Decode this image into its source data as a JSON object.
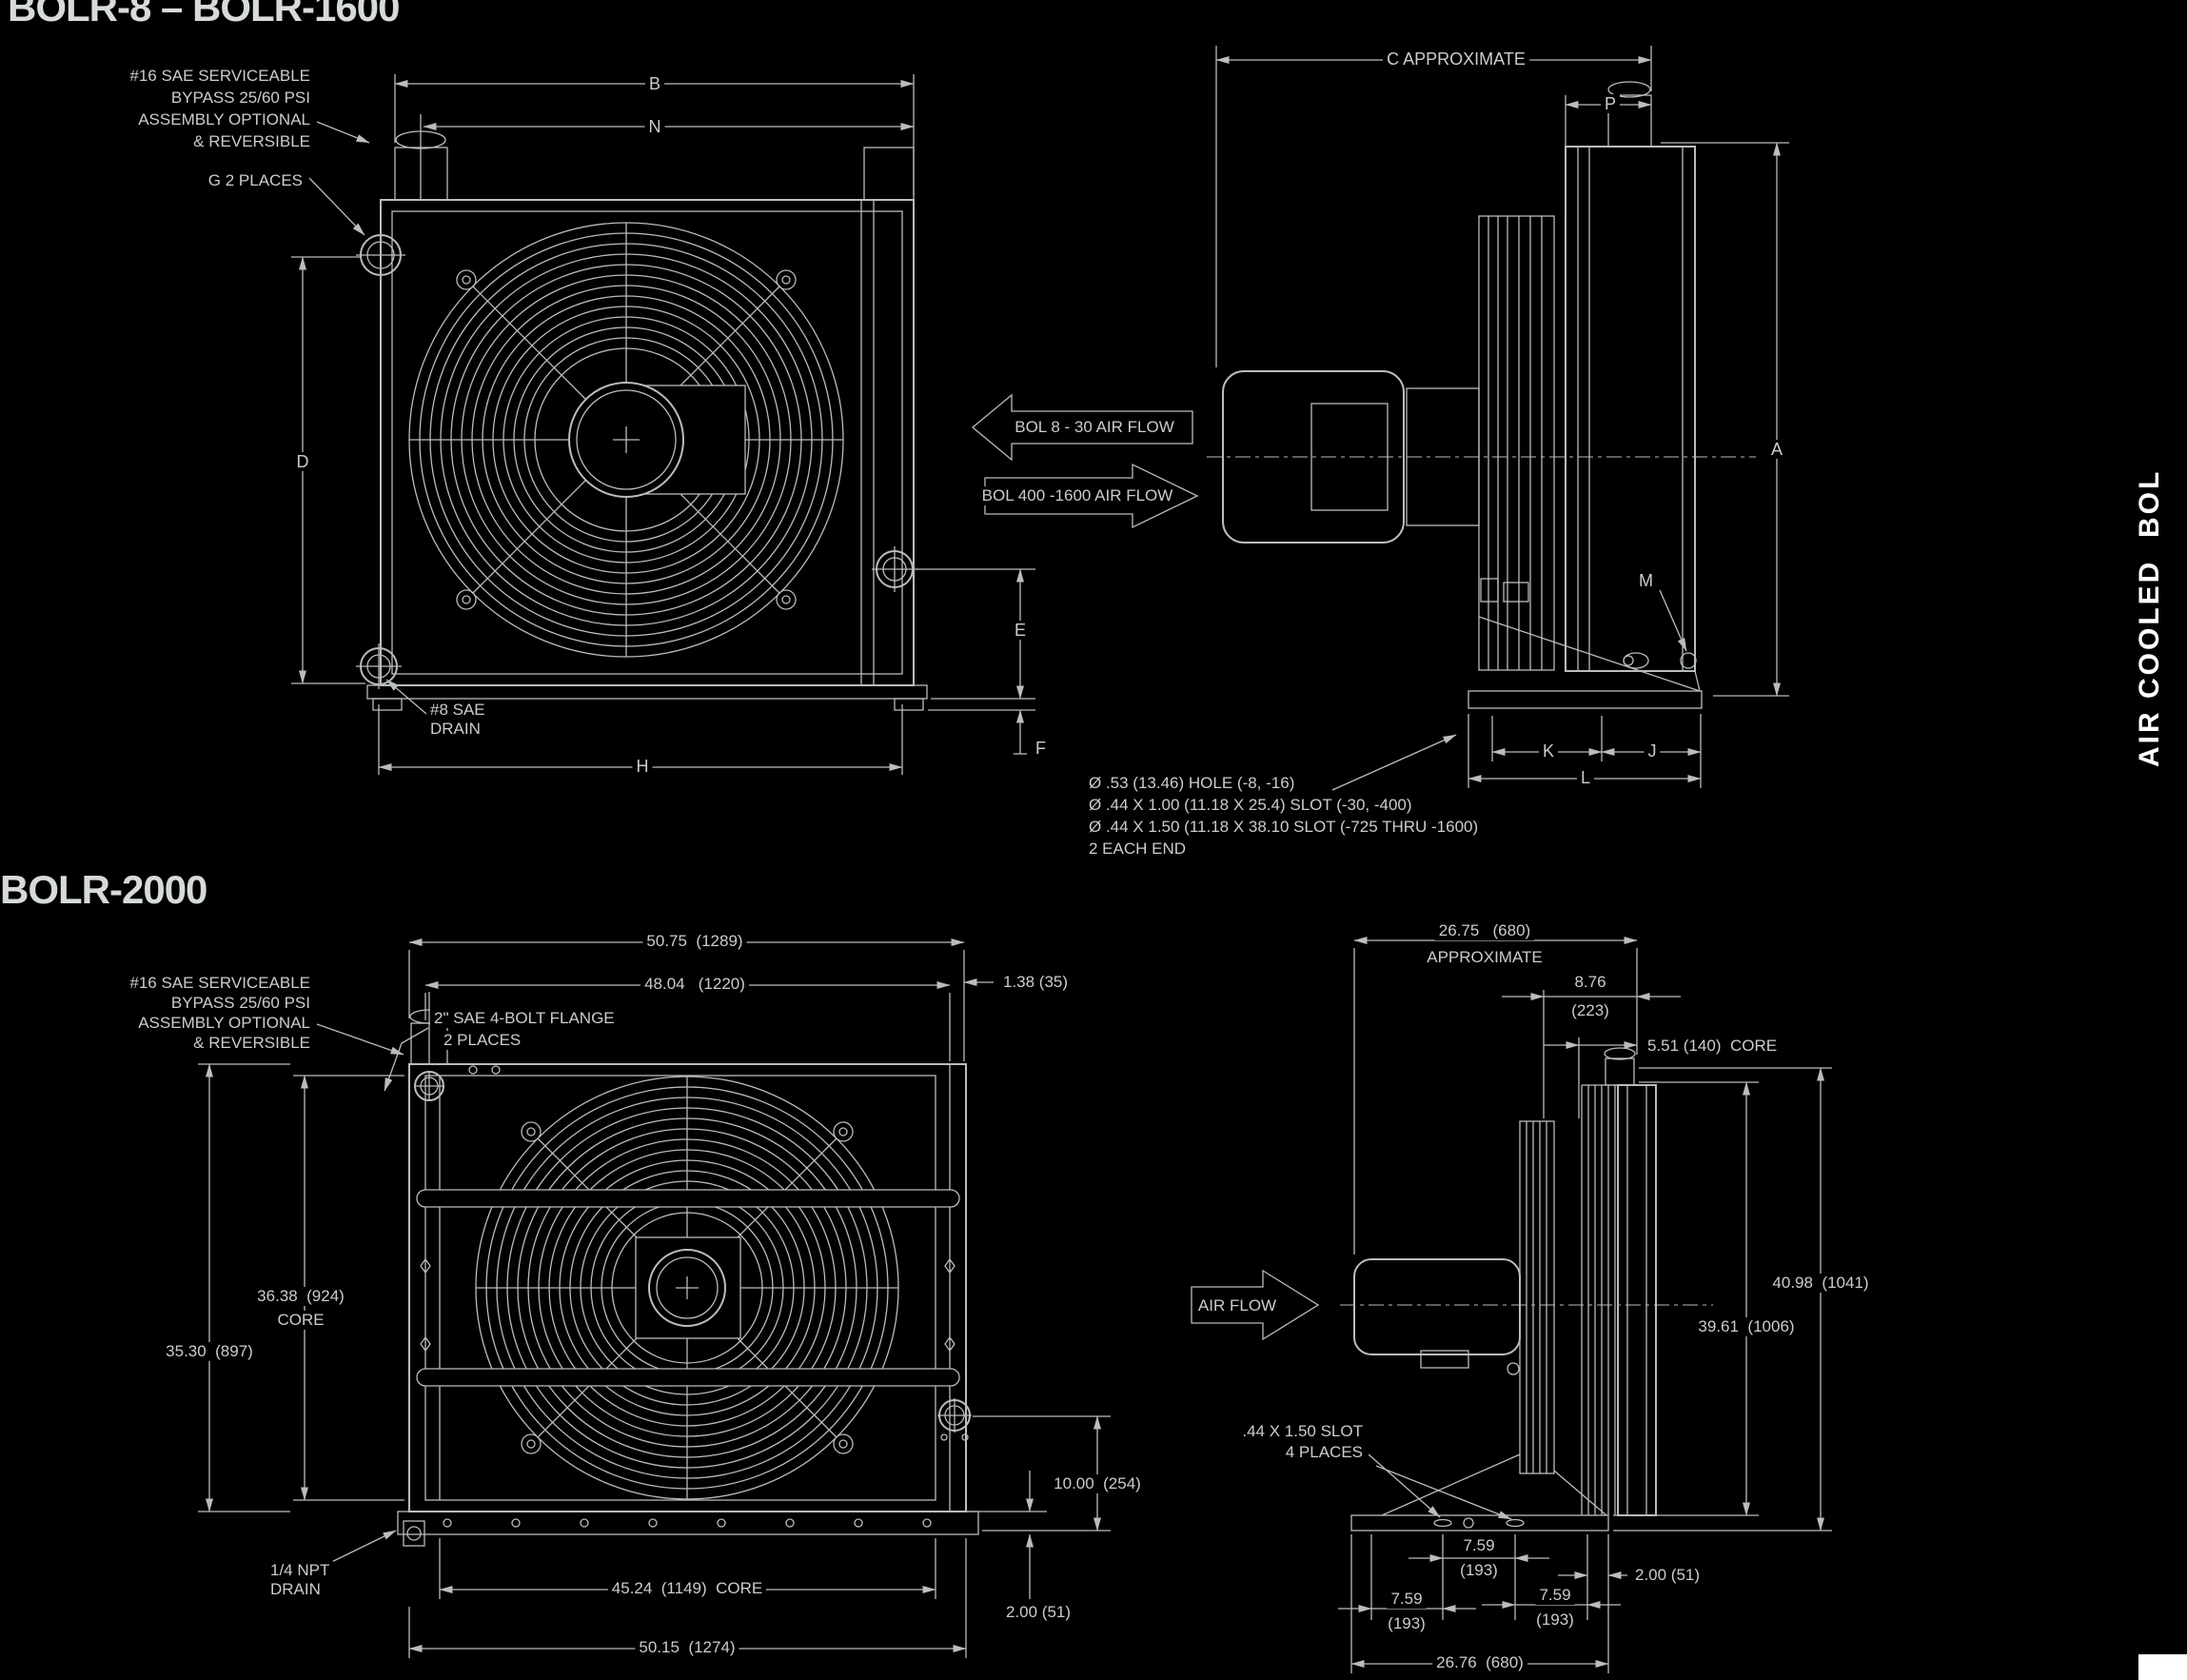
{
  "theme": {
    "background": "#000000",
    "line_color": "#b9bdbd",
    "text_color": "#c9cdcd",
    "title_color": "#d6dada",
    "brand_color": "#ffffff",
    "corner_color": "#ffffff"
  },
  "s1": {
    "title": "BOLR-8 – BOLR-1600",
    "bypass": [
      "#16 SAE SERVICEABLE",
      "BYPASS 25/60 PSI",
      "ASSEMBLY OPTIONAL",
      "& REVERSIBLE"
    ],
    "g_note": "G 2 PLACES",
    "drain": [
      "#8 SAE",
      "DRAIN"
    ],
    "dims": {
      "b": "B",
      "n": "N",
      "d": "D",
      "h": "H",
      "e": "E",
      "f": "F",
      "c": "C APPROXIMATE",
      "p": "P",
      "a": "A",
      "m": "M",
      "k": "K",
      "j": "J",
      "l": "L"
    },
    "airflow_left": "BOL 8 - 30 AIR FLOW",
    "airflow_right": "BOL 400 -1600 AIR FLOW",
    "hole_notes": [
      "Ø .53 (13.46) HOLE (-8, -16)",
      "Ø .44 X 1.00 (11.18 X 25.4) SLOT (-30, -400)",
      "Ø .44 X 1.50 (11.18 X 38.10 SLOT (-725 THRU -1600)",
      "2 EACH END"
    ]
  },
  "s2": {
    "title": "BOLR-2000",
    "bypass": [
      "#16 SAE SERVICEABLE",
      "BYPASS 25/60 PSI",
      "ASSEMBLY OPTIONAL",
      "& REVERSIBLE"
    ],
    "flange": [
      "2\" SAE 4-BOLT FLANGE",
      "2 PLACES"
    ],
    "drain": [
      "1/4 NPT",
      "DRAIN"
    ],
    "front_dims": {
      "w_overall": "50.75  (1289)",
      "w_inner": "48.04   (1220)",
      "offset": "1.38 (35)",
      "core_h": "36.38  (924)",
      "core_h2": "CORE",
      "h": "35.30  (897)",
      "leg": "10.00  (254)",
      "base": "2.00 (51)",
      "core_w": "45.24  (1149)  CORE",
      "w_bottom": "50.15  (1274)"
    },
    "airflow": "AIR FLOW",
    "slot_note": [
      ".44 X 1.50 SLOT",
      "4 PLACES"
    ],
    "side_dims": {
      "depth": "26.75   (680)",
      "depth2": "APPROXIMATE",
      "motor": "8.76",
      "motor2": "(223)",
      "core": "5.51 (140)  CORE",
      "h_overall": "40.98  (1041)",
      "h_core": "39.61  (1006)",
      "f1": "7.59",
      "f1b": "(193)",
      "f2": "7.59",
      "f2b": "(193)",
      "f3": "7.59",
      "f3b": "(193)",
      "edge": "2.00 (51)",
      "base_w": "26.76  (680)"
    }
  },
  "sidebar": {
    "vertical_label": "AIR COOLED  BOL"
  }
}
